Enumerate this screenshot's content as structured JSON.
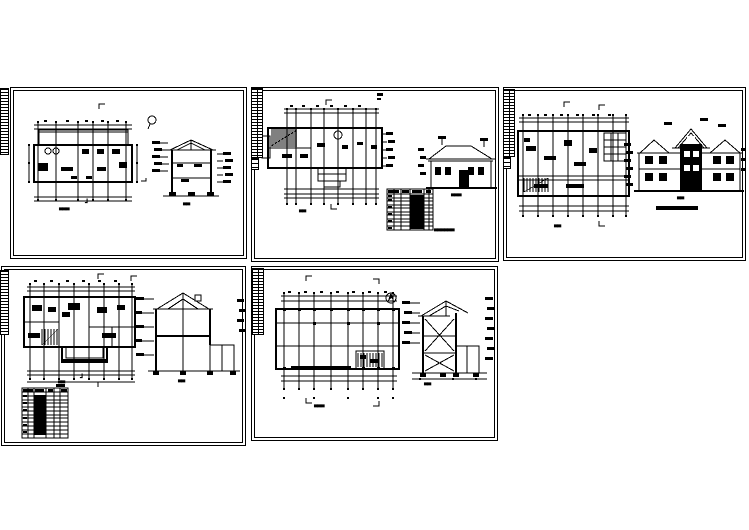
{
  "page": {
    "type": "cad-drawing-sheet-set",
    "background": "#ffffff",
    "line_color": "#000000",
    "sheet_count": 5
  },
  "icons": {
    "north_arrow": "north-arrow-icon",
    "compass": "compass-icon"
  },
  "sheets": [
    {
      "id": "sheet-1",
      "captions": {
        "plan": "▄▄▄",
        "plan_mark": "┛",
        "section": "▄▄"
      }
    },
    {
      "id": "sheet-2",
      "captions": {
        "plan": "▄▄",
        "elevation": "▄▄▄",
        "table": "▄▄▄▄▄▄"
      }
    },
    {
      "id": "sheet-3",
      "captions": {
        "plan": "▄▄",
        "elevation": "▄▄"
      }
    },
    {
      "id": "sheet-4",
      "captions": {
        "plan": "▄▄",
        "plan_mark": "┛",
        "section": "▄▄"
      }
    },
    {
      "id": "sheet-5",
      "captions": {
        "plan": "▄▄▄",
        "section": "▄▄"
      }
    }
  ]
}
